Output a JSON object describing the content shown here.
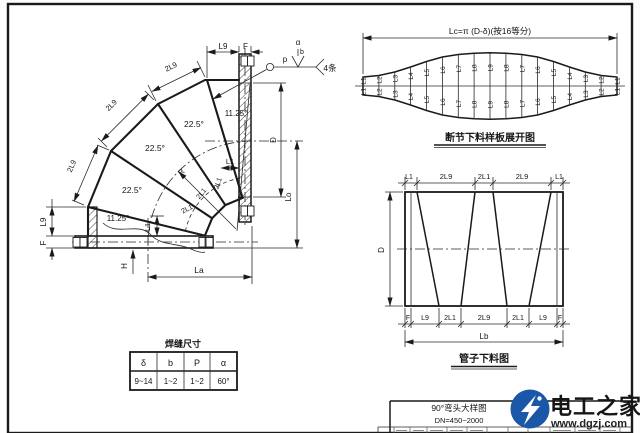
{
  "figure": {
    "type": "engineering-drawing",
    "accent_blue": "#1a57a8",
    "line_color": "#1a1a1a"
  },
  "elbow": {
    "dims": {
      "l9_top": "L9",
      "f_top": "F",
      "l1_top": "L1",
      "d": "D",
      "lo": "Lo",
      "la": "La",
      "h": "H",
      "l9_left": "L9",
      "f_left": "F",
      "l1_bottom": "L1",
      "r": "R"
    },
    "angle_labels": [
      "11.25°",
      "22.5°",
      "22.5°",
      "22.5°",
      "11.25°"
    ],
    "outer_dims": [
      "2L9",
      "2L9",
      "2L9"
    ],
    "inner_dims": [
      "2L1",
      "2L1",
      "2L1"
    ],
    "callout": {
      "p": "p",
      "alpha": "α",
      "b": "b",
      "count": "4条"
    }
  },
  "weld_table": {
    "title": "焊缝尺寸",
    "headers": [
      "δ",
      "b",
      "P",
      "α"
    ],
    "values": [
      "9~14",
      "1~2",
      "1~2",
      "60°"
    ]
  },
  "development": {
    "dim_label": "Lc=π (D-δ)(按16等分)",
    "title": "断节下料样板展开图",
    "ordinate_labels": [
      "L1",
      "L2",
      "L3",
      "L4",
      "L5",
      "L6",
      "L7",
      "L8",
      "L9",
      "L8",
      "L7",
      "L6",
      "L5",
      "L4",
      "L3",
      "L2",
      "L1"
    ]
  },
  "pipe_layout": {
    "title": "管子下料图",
    "top_dims": [
      "L1",
      "2L9",
      "2L1",
      "2L9",
      "L1"
    ],
    "bottom_dims": [
      "F",
      "L9",
      "2L1",
      "2L9",
      "2L1",
      "L9",
      "F"
    ],
    "left_dim": "D",
    "total_dim": "Lb"
  },
  "title_block": {
    "line1": "90°弯头大样图",
    "line2": "DN=450~2000"
  },
  "watermark": {
    "name": "电工之家",
    "url": "www.dgzj.com"
  }
}
